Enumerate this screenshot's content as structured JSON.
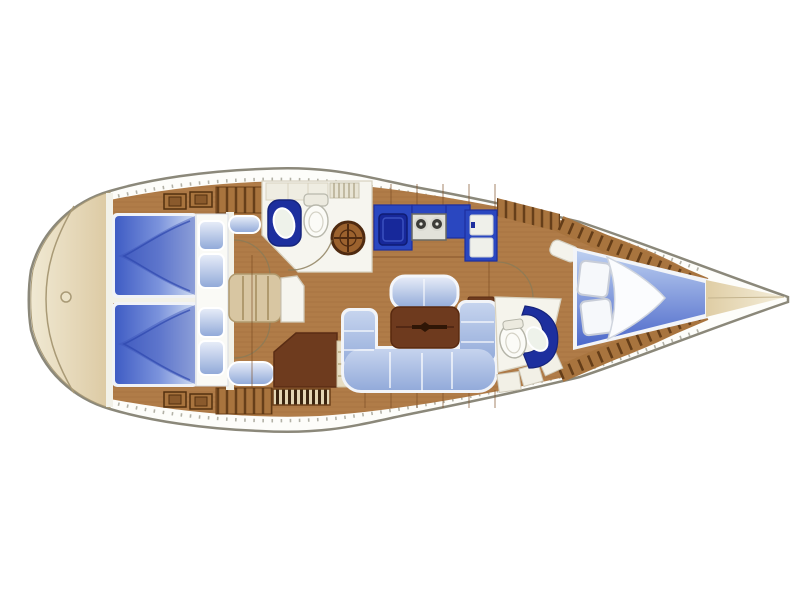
{
  "title": "Sailing yacht interior layout floor plan, bow pointing right",
  "palette": {
    "background": "#ffffff",
    "hull_outline": "#8b887a",
    "hull_fill": "#fdfdfa",
    "stern_deck": "#e9dfc4",
    "bow_deck": "#e8d9b2",
    "wood_floor": "#b07c48",
    "wood_band": "#a8743e",
    "slat_dark": "#53300f",
    "trim_white": "#f2f1e8",
    "fixture_white": "#f7f6ef",
    "berth_blue_deep": "#3f5cc4",
    "berth_blue_light": "#cfdcf2",
    "settee_blue": "#aec2e6",
    "pillow_blue": "#9ab4e4",
    "navy_counter": "#1d2f9e",
    "galley_counter": "#2a47c0",
    "sink_navy": "#17289a",
    "stove_gray": "#e2e2da",
    "burner_dark": "#3c3c38",
    "table_brown": "#6e3a1e",
    "desk_brown": "#6e3b1e",
    "steps_tan": "#d8c6a2",
    "grate_brown": "#9c622e",
    "grate_base": "#e4d6b4",
    "basin_white": "#eef2ea"
  },
  "areas": {
    "stern_deck": "stern-transom-platform",
    "aft_cabin_port": "aft-double-berth-port",
    "aft_cabin_starboard": "aft-double-berth-starboard",
    "companionway": "companionway-steps",
    "nav_station": "chart-table",
    "head_aft": "aft-bathroom-with-shower",
    "galley": "galley-with-sink-stove-fridge",
    "salon": "u-shaped-settee-with-table",
    "head_forward": "forward-bathroom",
    "forward_cabin": "v-berth-forward-cabin",
    "bow_deck": "bow-anchor-deck"
  }
}
